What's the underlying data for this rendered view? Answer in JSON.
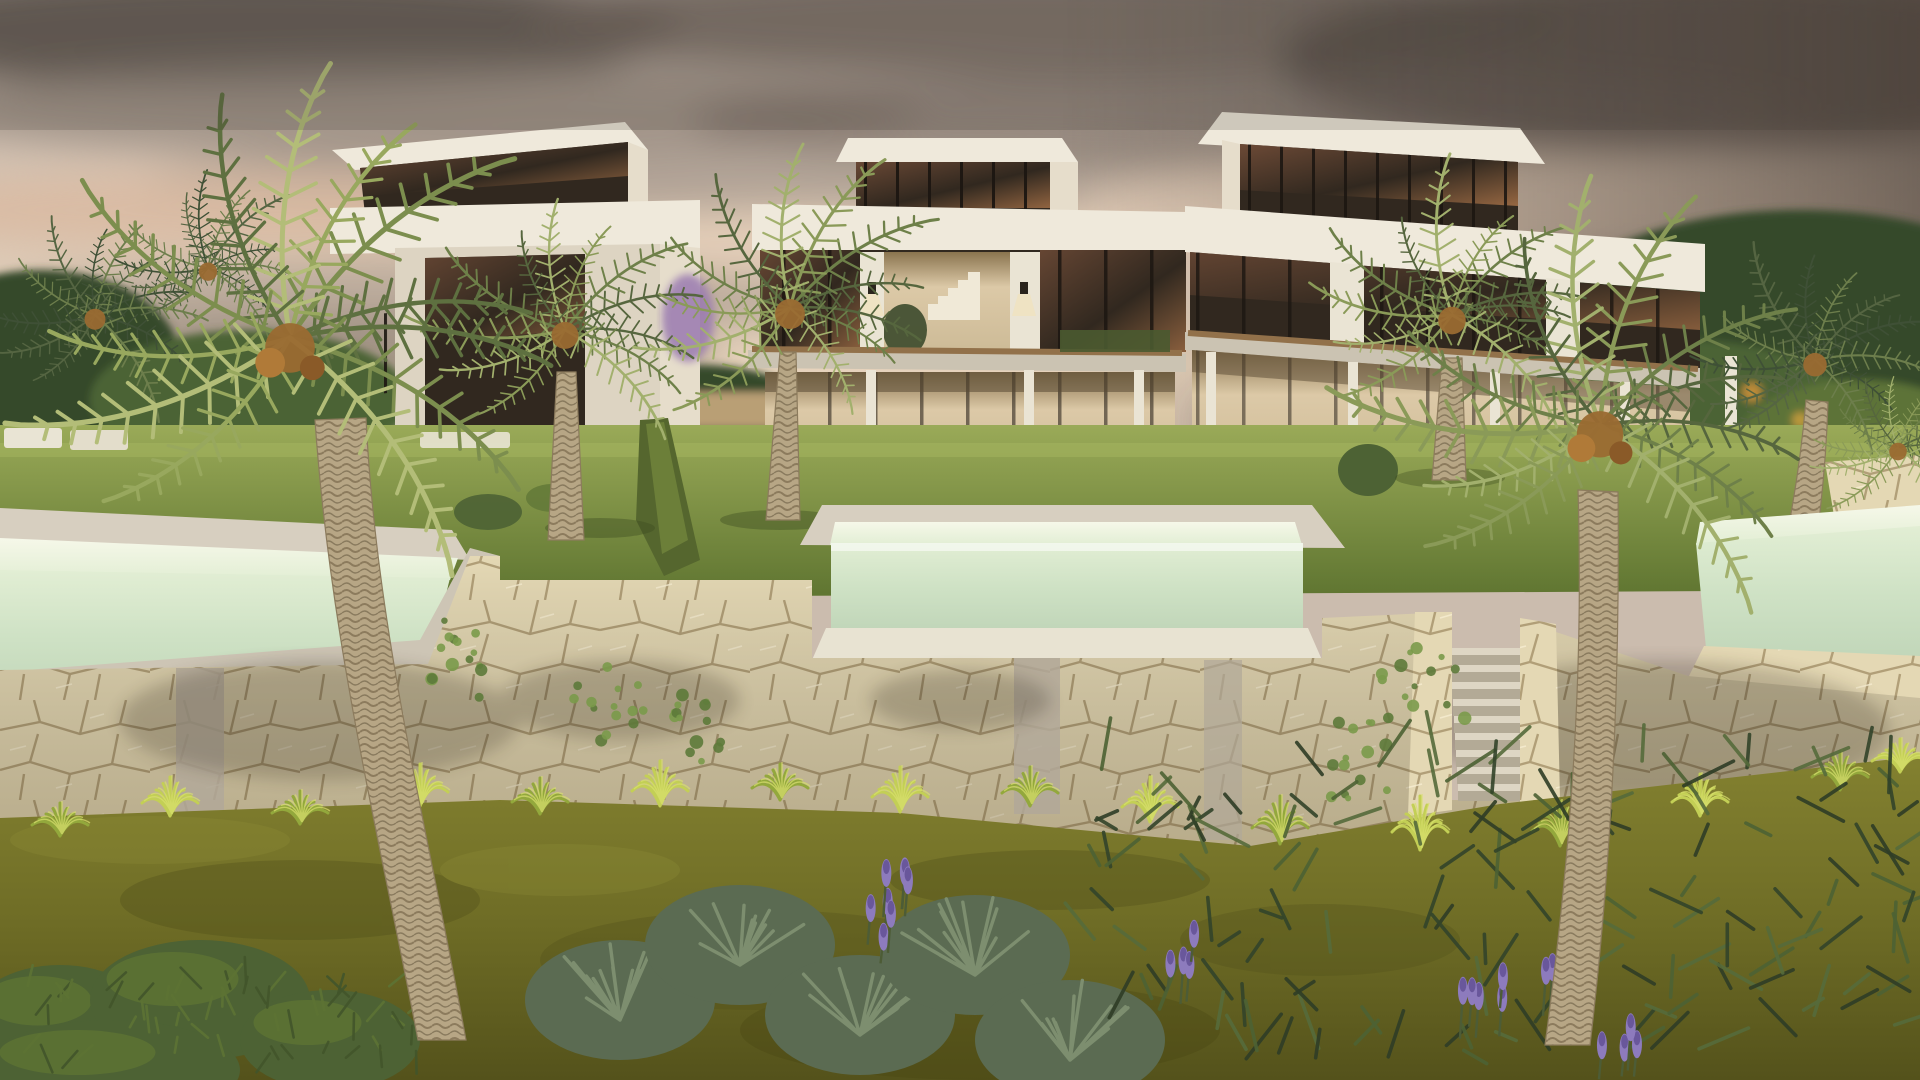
{
  "scene": {
    "type": "architectural-3d-render",
    "description": "Dusk exterior rendering of three modern two-storey white villas with rooftop glass penthouses, raised infinity pools on cream flagstone retaining walls, a stone staircase, lawns, ornamental grasses, lavender shrubs and large palm trees under a cloudy sunset sky.",
    "time_of_day": "dusk",
    "villas": [
      {
        "name": "left-villa",
        "storeys": 2,
        "penthouse": true,
        "lit_interior": false
      },
      {
        "name": "center-villa",
        "storeys": 2,
        "penthouse": true,
        "lit_interior": true
      },
      {
        "name": "right-villa",
        "storeys": 2,
        "penthouse": true,
        "lit_interior": true
      }
    ],
    "pools": [
      "left-infinity-pool",
      "center-infinity-pool",
      "right-infinity-pool"
    ],
    "features": [
      "flagstone-retaining-walls",
      "stone-staircase",
      "wall-sconces",
      "wood-deck-balconies",
      "white-columns",
      "ivy-on-wall",
      "ornamental-grass-row",
      "lavender-spikes",
      "clipped-hedges"
    ],
    "palms_visible": 10,
    "sky": "layered grey and pink sunset clouds, darker at top right"
  },
  "palette": {
    "sky-top": "#b9aca4",
    "sky-mid": "#d9c7b5",
    "sky-low": "#d2bfae",
    "sky-glow": "#e7d3bc",
    "cloud-dark": "#73685f",
    "cloud-darker": "#5b524b",
    "cloud-grey": "#95897f",
    "cloud-light": "#e5cfb8",
    "cloud-pink": "#d9b9a0",
    "villa-white": "#efe9db",
    "villa-shade": "#ddd4c2",
    "villa-side": "#e6ddcb",
    "fascia-edge": "#cfc6b2",
    "glass-dark": "#31281f",
    "glass-amber": "#77503a",
    "glass-amber-light": "#a87248",
    "frame-dark": "#1c1611",
    "interior-warm": "#dcc9a7",
    "interior-floor": "#cdbb97",
    "stair-white": "#f0e9d7",
    "deck-wood": "#92714a",
    "slab-light": "#cbc3b2",
    "column-white": "#eae4d4",
    "lawn-light": "#9aaa58",
    "lawn-mid": "#7c9040",
    "lawn-dark": "#5e7430",
    "stone-base": "#e4d8b4",
    "stone-joint": "#a08c64",
    "stone-light": "#f2e9cb",
    "stone-grey": "#b1a899",
    "coping": "#d2cabа",
    "coping-light": "#d7cfc0",
    "water-glow": "#f6f8e9",
    "water-light": "#e2eed4",
    "water-mid": "#cfe2c5",
    "water-deep": "#c1d6b9",
    "trunk-base": "#b7a685",
    "trunk-dark": "#8c7b5d",
    "frond-d1": "#3f5036",
    "frond-d2": "#556542",
    "frond-d3": "#6d7e4c",
    "frond-m1": "#56663e",
    "frond-m2": "#6e8049",
    "frond-m3": "#8a9a58",
    "frond-m4": "#a2b06d",
    "frond-b1": "#5e7040",
    "frond-b2": "#7c8e4e",
    "frond-b3": "#98a85e",
    "frond-b4": "#b3bd78",
    "dates": "#9a6a32",
    "tuft-1": "#c3cf55",
    "tuft-2": "#93a83c",
    "tuft-3": "#d8e06e",
    "fg-lawn": "#6f6d26",
    "fg-lawn-dark": "#54521b",
    "fg-lawn-light": "#838130",
    "shrub-dark": "#33442a",
    "shrub-mid": "#4d6234",
    "sage": "#5b6b52",
    "sage-light": "#7d8e6f",
    "lavender": "#8d7bbd",
    "lavender-dark": "#69579b",
    "bougainvillea": "#9a7ab0",
    "tree-green": "#4c6435",
    "tree-dark": "#36492a",
    "shadow": "#2c2c18"
  }
}
